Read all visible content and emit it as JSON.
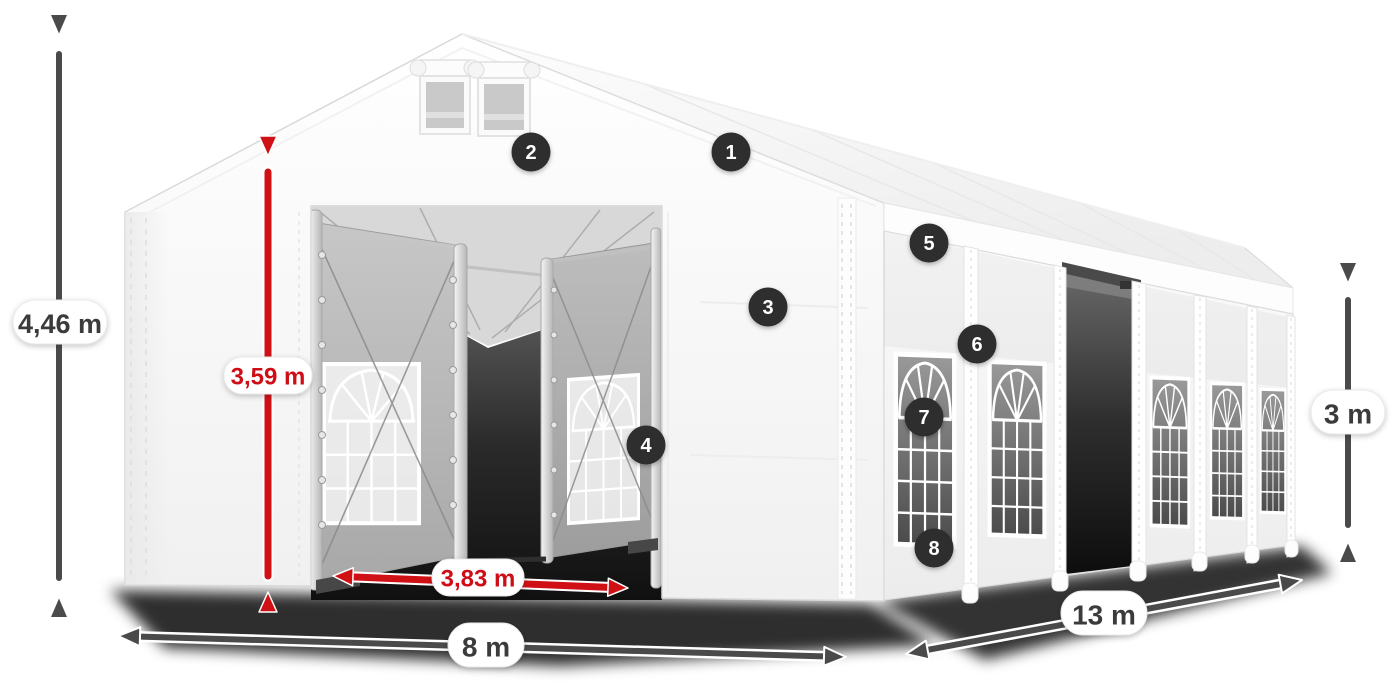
{
  "diagram": {
    "type": "marquee-tent-dimension-diagram",
    "dimensions": {
      "total_height": "4,46 m",
      "entrance_height": "3,59 m",
      "entrance_width": "3,83 m",
      "front_width": "8 m",
      "side_length": "13 m",
      "wall_height": "3 m"
    },
    "badges": [
      {
        "number": "1"
      },
      {
        "number": "2"
      },
      {
        "number": "3"
      },
      {
        "number": "4"
      },
      {
        "number": "5"
      },
      {
        "number": "6"
      },
      {
        "number": "7"
      },
      {
        "number": "8"
      }
    ],
    "colors": {
      "highlight_red": "#cf1116",
      "dimension_dark": "#4a4a4a",
      "badge_background": "#2d2d2d",
      "badge_text": "#ffffff",
      "label_text": "#3a3a3a",
      "label_background": "#ffffff",
      "canvas_background": "#ffffff"
    }
  }
}
